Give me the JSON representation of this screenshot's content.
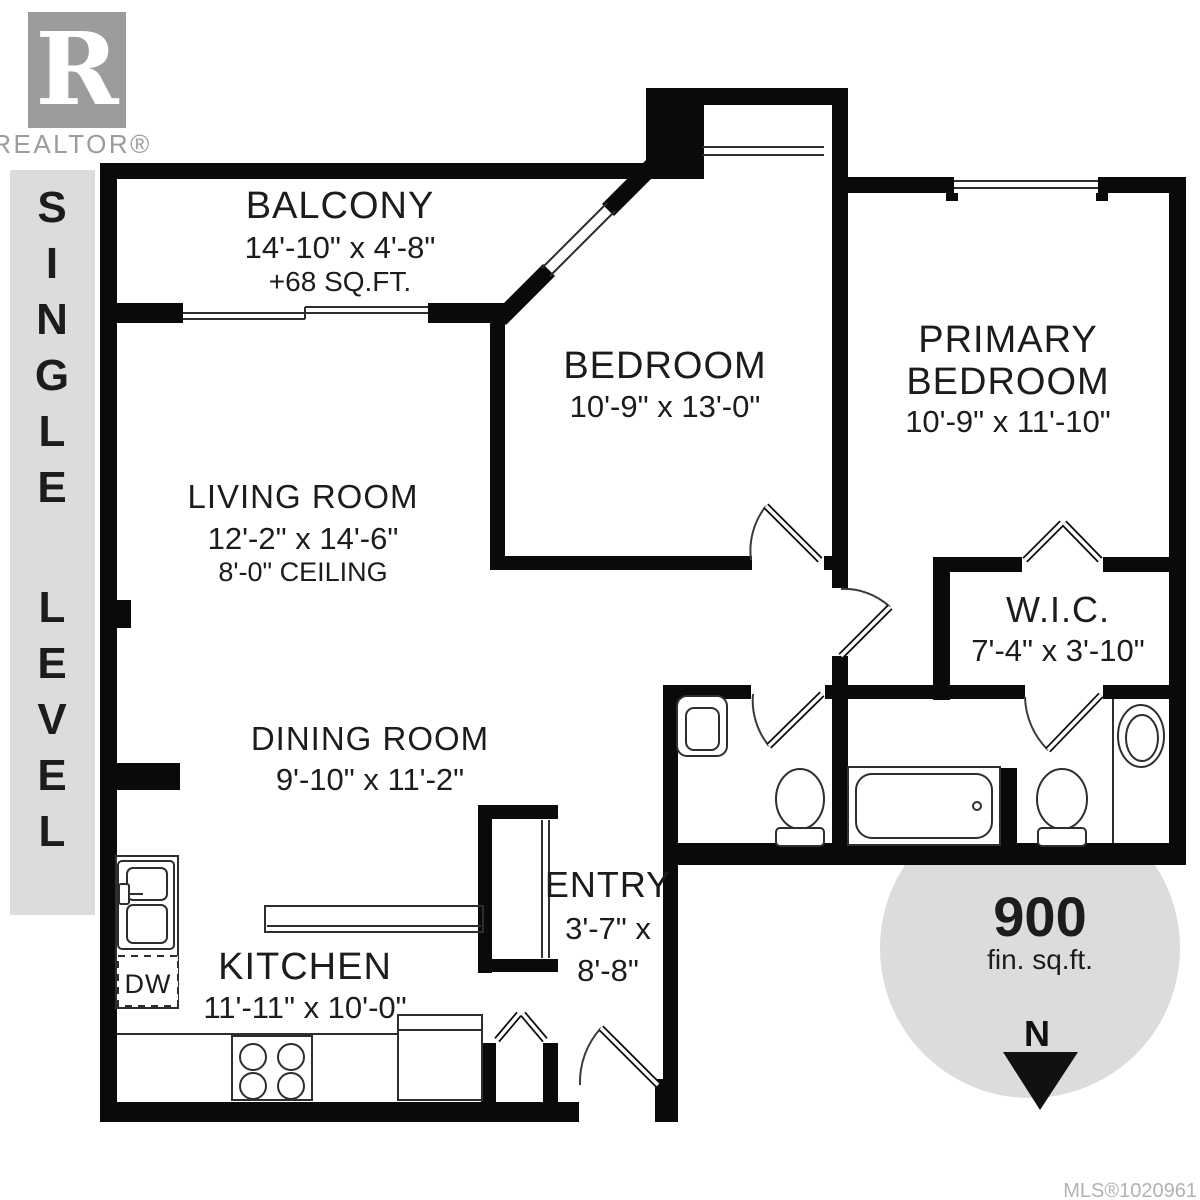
{
  "branding": {
    "logo_letter": "R",
    "wordmark": "REALTOR®"
  },
  "sidebar": {
    "label": "SINGLE LEVEL",
    "letters": [
      "S",
      "I",
      "N",
      "G",
      "L",
      "E",
      "L",
      "E",
      "V",
      "E",
      "L"
    ]
  },
  "rooms": {
    "balcony": {
      "name": "BALCONY",
      "dims": "14'-10\" x 4'-8\"",
      "area": "+68 SQ.FT."
    },
    "bedroom": {
      "name": "BEDROOM",
      "dims": "10'-9\" x 13'-0\""
    },
    "primary_bedroom": {
      "name_line1": "PRIMARY",
      "name_line2": "BEDROOM",
      "dims": "10'-9\" x 11'-10\""
    },
    "living_room": {
      "name": "LIVING ROOM",
      "dims": "12'-2\" x 14'-6\"",
      "ceiling": "8'-0\" CEILING"
    },
    "dining_room": {
      "name": "DINING ROOM",
      "dims": "9'-10\" x 11'-2\""
    },
    "wic": {
      "name": "W.I.C.",
      "dims": "7'-4\" x 3'-10\""
    },
    "kitchen": {
      "name": "KITCHEN",
      "dims": "11'-11\" x 10'-0\""
    },
    "entry": {
      "name": "ENTRY",
      "dims_line1": "3'-7\" x",
      "dims_line2": "8'-8\""
    }
  },
  "labels": {
    "dishwasher": "DW"
  },
  "area_badge": {
    "value": "900",
    "unit": "fin. sq.ft."
  },
  "compass": {
    "north": "N"
  },
  "footer": {
    "mls": "MLS®1020961"
  },
  "colors": {
    "wall": "#0a0a0a",
    "line": "#2e2e2e",
    "light_gray": "#dcdcdc",
    "logo_gray": "#9c9c9c",
    "text": "#1c1c1c",
    "mls_text": "#b2b2b2"
  }
}
